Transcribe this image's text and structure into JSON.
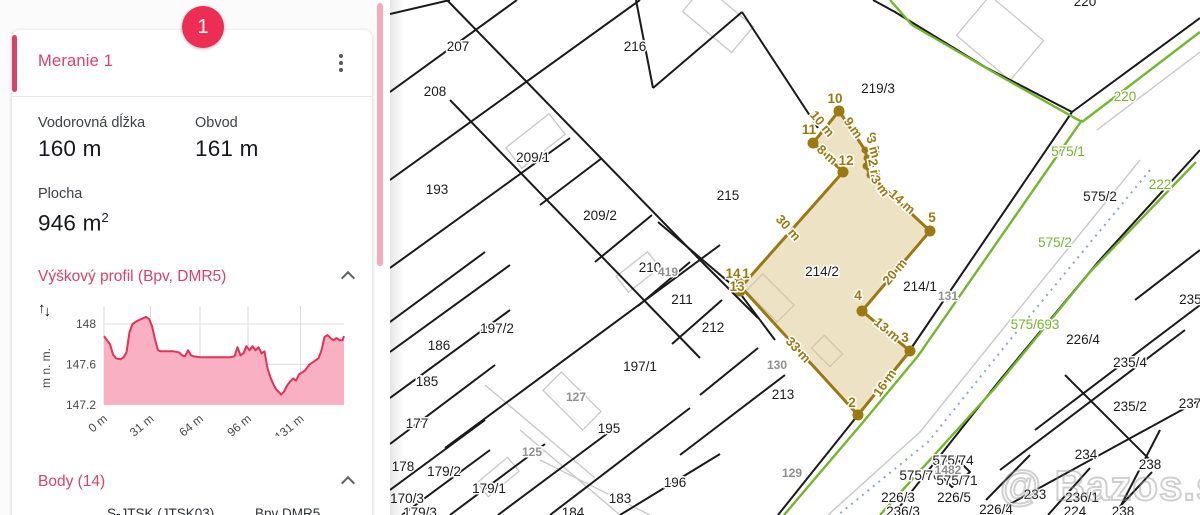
{
  "colors": {
    "accent_pink": "#d94368",
    "badge_red": "#ee2d55",
    "scrollbar_pink": "#f6a8bc",
    "value_dark": "#16181d",
    "chart_line": "#e73058",
    "chart_fill": "#f8b0c2",
    "map_line": "#1a1a1a",
    "map_green": "#74b62c",
    "map_gray": "#c9c9c9",
    "map_dotted": "#8fa6c2",
    "gold": "#9a7a10",
    "gold_fill": "rgba(222,197,138,0.5)",
    "parcel_label": "#1c1c1c",
    "gray_label": "#8f8f8f"
  },
  "panel": {
    "badge": "1",
    "title": "Meranie 1",
    "metric1_label": "Vodorovná dĺžka",
    "metric1_value": "160 m",
    "metric2_label": "Obvod",
    "metric2_value": "161 m",
    "area_label": "Plocha",
    "area_value": "946 m",
    "area_sup": "2",
    "profile_title": "Výškový profil (Bpv, DMR5)",
    "body_title": "Body (14)",
    "body_table_col1": "S-JTSK (JTSK03)",
    "body_table_col2": "Bpv DMR5"
  },
  "chart_data": {
    "type": "area",
    "title": "Výškový profil (Bpv, DMR5)",
    "ylabel": "m n. m.",
    "xlabel": "",
    "xlim": [
      0,
      160
    ],
    "ylim": [
      147.2,
      148.1
    ],
    "y_ticks": [
      "148",
      "147.6",
      "147.2"
    ],
    "y_tick_values": [
      148,
      147.6,
      147.2
    ],
    "x_ticks": [
      "0 m",
      "31 m",
      "64 m",
      "96 m",
      "131 m"
    ],
    "x_tick_values": [
      0,
      31,
      64,
      96,
      131
    ],
    "grid": true,
    "profile": [
      [
        0,
        147.88
      ],
      [
        2,
        147.84
      ],
      [
        4,
        147.8
      ],
      [
        6,
        147.7
      ],
      [
        8,
        147.66
      ],
      [
        11,
        147.65
      ],
      [
        13,
        147.67
      ],
      [
        15,
        147.72
      ],
      [
        17,
        147.92
      ],
      [
        19,
        148.0
      ],
      [
        22,
        148.03
      ],
      [
        25,
        148.05
      ],
      [
        28,
        148.07
      ],
      [
        30,
        148.05
      ],
      [
        32,
        147.98
      ],
      [
        34,
        147.85
      ],
      [
        36,
        147.74
      ],
      [
        38,
        147.73
      ],
      [
        42,
        147.73
      ],
      [
        46,
        147.73
      ],
      [
        50,
        147.72
      ],
      [
        52,
        147.69
      ],
      [
        54,
        147.68
      ],
      [
        56,
        147.74
      ],
      [
        58,
        147.69
      ],
      [
        60,
        147.68
      ],
      [
        64,
        147.67
      ],
      [
        68,
        147.67
      ],
      [
        72,
        147.67
      ],
      [
        76,
        147.67
      ],
      [
        80,
        147.67
      ],
      [
        84,
        147.67
      ],
      [
        87,
        147.68
      ],
      [
        89,
        147.77
      ],
      [
        91,
        147.69
      ],
      [
        93,
        147.71
      ],
      [
        95,
        147.78
      ],
      [
        97,
        147.74
      ],
      [
        99,
        147.78
      ],
      [
        101,
        147.74
      ],
      [
        103,
        147.77
      ],
      [
        105,
        147.71
      ],
      [
        107,
        147.73
      ],
      [
        109,
        147.56
      ],
      [
        111,
        147.47
      ],
      [
        113,
        147.4
      ],
      [
        115,
        147.35
      ],
      [
        117,
        147.32
      ],
      [
        118,
        147.3
      ],
      [
        120,
        147.33
      ],
      [
        122,
        147.39
      ],
      [
        124,
        147.43
      ],
      [
        126,
        147.46
      ],
      [
        128,
        147.44
      ],
      [
        130,
        147.5
      ],
      [
        132,
        147.52
      ],
      [
        134,
        147.54
      ],
      [
        137,
        147.6
      ],
      [
        140,
        147.63
      ],
      [
        143,
        147.66
      ],
      [
        145,
        147.74
      ],
      [
        147,
        147.87
      ],
      [
        149,
        147.89
      ],
      [
        151,
        147.86
      ],
      [
        153,
        147.84
      ],
      [
        155,
        147.86
      ],
      [
        157,
        147.84
      ],
      [
        159,
        147.84
      ],
      [
        160,
        147.88
      ]
    ]
  },
  "map": {
    "watermark": "@ Bazos.sk",
    "parcel_labels": [
      {
        "t": "207",
        "x": 68,
        "y": 47
      },
      {
        "t": "208",
        "x": 45,
        "y": 92
      },
      {
        "t": "216",
        "x": 245,
        "y": 47
      },
      {
        "t": "219/3",
        "x": 488,
        "y": 89
      },
      {
        "t": "193",
        "x": 47,
        "y": 190
      },
      {
        "t": "209/1",
        "x": 143,
        "y": 158
      },
      {
        "t": "215",
        "x": 338,
        "y": 196
      },
      {
        "t": "209/2",
        "x": 210,
        "y": 216
      },
      {
        "t": "210",
        "x": 260,
        "y": 268
      },
      {
        "t": "211",
        "x": 292,
        "y": 300
      },
      {
        "t": "212",
        "x": 323,
        "y": 328
      },
      {
        "t": "214/2",
        "x": 432,
        "y": 272
      },
      {
        "t": "214/1",
        "x": 530,
        "y": 287
      },
      {
        "t": "197/2",
        "x": 107,
        "y": 329
      },
      {
        "t": "186",
        "x": 49,
        "y": 346
      },
      {
        "t": "185",
        "x": 37,
        "y": 382
      },
      {
        "t": "177",
        "x": 27,
        "y": 424
      },
      {
        "t": "197/1",
        "x": 250,
        "y": 367
      },
      {
        "t": "195",
        "x": 219,
        "y": 429
      },
      {
        "t": "213",
        "x": 393,
        "y": 395
      },
      {
        "t": "178",
        "x": 13,
        "y": 467
      },
      {
        "t": "179/2",
        "x": 54,
        "y": 472
      },
      {
        "t": "179/1",
        "x": 99,
        "y": 489
      },
      {
        "t": "170/3",
        "x": 17,
        "y": 499
      },
      {
        "t": "179/3",
        "x": 30,
        "y": 513
      },
      {
        "t": "183",
        "x": 230,
        "y": 499
      },
      {
        "t": "184",
        "x": 183,
        "y": 513
      },
      {
        "t": "196",
        "x": 285,
        "y": 483
      },
      {
        "t": "226/4",
        "x": 693,
        "y": 340
      },
      {
        "t": "235/4",
        "x": 740,
        "y": 363
      },
      {
        "t": "235/2",
        "x": 740,
        "y": 407
      },
      {
        "t": "234",
        "x": 696,
        "y": 455
      },
      {
        "t": "238",
        "x": 760,
        "y": 465
      },
      {
        "t": "237",
        "x": 800,
        "y": 404
      },
      {
        "t": "233",
        "x": 645,
        "y": 495
      },
      {
        "t": "236/1",
        "x": 692,
        "y": 498
      },
      {
        "t": "226/4",
        "x": 606,
        "y": 510
      },
      {
        "t": "224",
        "x": 685,
        "y": 512
      },
      {
        "t": "238",
        "x": 733,
        "y": 512
      },
      {
        "t": "226/3",
        "x": 508,
        "y": 498
      },
      {
        "t": "226/5",
        "x": 564,
        "y": 498
      },
      {
        "t": "236/3",
        "x": 513,
        "y": 512
      },
      {
        "t": "575/2",
        "x": 710,
        "y": 197
      },
      {
        "t": "220",
        "x": 695,
        "y": 2
      },
      {
        "t": "575/70",
        "x": 530,
        "y": 476
      },
      {
        "t": "575/71",
        "x": 567,
        "y": 481
      },
      {
        "t": "575/74",
        "x": 563,
        "y": 461
      },
      {
        "t": "235/1",
        "x": 806,
        "y": 300
      }
    ],
    "gray_labels": [
      {
        "t": "419",
        "x": 278,
        "y": 272
      },
      {
        "t": "127",
        "x": 186,
        "y": 397
      },
      {
        "t": "125",
        "x": 142,
        "y": 452
      },
      {
        "t": "129",
        "x": 402,
        "y": 473
      },
      {
        "t": "130",
        "x": 387,
        "y": 365
      },
      {
        "t": "131",
        "x": 558,
        "y": 296
      },
      {
        "t": "1482",
        "x": 558,
        "y": 470
      }
    ],
    "green_labels": [
      {
        "t": "220",
        "x": 735,
        "y": 97
      },
      {
        "t": "575/1",
        "x": 678,
        "y": 152
      },
      {
        "t": "575/2",
        "x": 665,
        "y": 243
      },
      {
        "t": "575/693",
        "x": 645,
        "y": 325
      },
      {
        "t": "222",
        "x": 770,
        "y": 185
      }
    ],
    "black_lines": [
      "0,14 60,0",
      "0,92 127,0",
      "0,180 250,0",
      "0,268 180,138",
      "0,322 95,252",
      "0,352 120,265",
      "0,398 120,310",
      "0,444 105,365",
      "0,490 95,420",
      "12,515 100,450",
      "60,515 155,444",
      "108,515 230,424",
      "55,448 330,245",
      "160,515 300,408",
      "230,515 330,454",
      "290,455 395,375",
      "57,0 312,262",
      "60,100 310,358",
      "150,205 212,158",
      "205,262 262,215",
      "248,306 300,262",
      "282,344 332,300",
      "310,395 368,348",
      "263,88 352,12",
      "263,88 246,0",
      "428,128 352,12",
      "348,290 268,222",
      "352,296 385,340",
      "312,262 368,318",
      "682,112 520,350 468,415 388,515",
      "682,112 595,67 505,12 483,0",
      "682,112 810,18",
      "810,150 708,262 610,380 503,515",
      "645,430 810,305",
      "610,470 795,330",
      "600,515 810,400",
      "770,430 726,515",
      "675,375 760,460",
      "745,300 810,250",
      "640,455 596,500",
      "700,468 658,515",
      "762,472 722,515",
      "545,470 563,455 580,472 562,487 545,470"
    ],
    "green_lines": [
      "692,120 528,356 474,421 394,515",
      "810,32 692,122",
      "692,122 610,76 522,25 500,0",
      "806,162 700,272 605,388 490,515"
    ],
    "gray_lines": [
      "750,160 612,330 530,432 438,515",
      "707,130 810,52",
      "130,430 230,515",
      "95,385 205,478",
      "150,460 260,515"
    ],
    "dotted_lines": [
      "760,170 620,340 538,442 448,515"
    ],
    "buildings": [
      {
        "x": 118,
        "y": 128,
        "w": 55,
        "h": 26,
        "r": -38
      },
      {
        "x": 358,
        "y": 286,
        "w": 44,
        "h": 24,
        "r": 45
      },
      {
        "x": 424,
        "y": 342,
        "w": 26,
        "h": 18,
        "r": 45
      },
      {
        "x": 228,
        "y": 262,
        "w": 40,
        "h": 20,
        "r": -38
      },
      {
        "x": 296,
        "y": 2,
        "w": 64,
        "h": 34,
        "r": 40
      },
      {
        "x": 575,
        "y": 12,
        "w": 70,
        "h": 52,
        "r": 40
      },
      {
        "x": 88,
        "y": 468,
        "w": 40,
        "h": 18,
        "r": -40
      },
      {
        "x": 154,
        "y": 388,
        "w": 56,
        "h": 26,
        "r": 45
      }
    ],
    "measurement": {
      "polygon": "351,287 453,172 423,143 449,111 475,150 477,158 476,166 480,175 540,231 472,311 520,351 468,415",
      "vertices_large": [
        [
          449,
          111
        ],
        [
          423,
          143
        ],
        [
          453,
          172
        ],
        [
          540,
          231
        ],
        [
          472,
          311
        ],
        [
          520,
          351
        ],
        [
          468,
          415
        ],
        [
          349,
          283
        ],
        [
          350,
          291
        ]
      ],
      "vertices_small": [
        [
          475,
          150
        ],
        [
          477,
          158
        ],
        [
          476,
          166
        ],
        [
          480,
          175
        ]
      ],
      "vertex_labels": [
        {
          "t": "10",
          "x": 445,
          "y": 99
        },
        {
          "t": "11",
          "x": 419,
          "y": 130
        },
        {
          "t": "12",
          "x": 456,
          "y": 161
        },
        {
          "t": "9",
          "x": 483,
          "y": 138
        },
        {
          "t": "8",
          "x": 486,
          "y": 151
        },
        {
          "t": "7",
          "x": 484,
          "y": 163
        },
        {
          "t": "6",
          "x": 487,
          "y": 175
        },
        {
          "t": "5",
          "x": 542,
          "y": 218
        },
        {
          "t": "4",
          "x": 468,
          "y": 296
        },
        {
          "t": "3",
          "x": 515,
          "y": 338
        },
        {
          "t": "2",
          "x": 462,
          "y": 403
        },
        {
          "t": "14",
          "x": 343,
          "y": 274
        },
        {
          "t": "1",
          "x": 356,
          "y": 274
        },
        {
          "t": "13",
          "x": 347,
          "y": 287
        }
      ],
      "edge_labels": [
        {
          "t": "8 m",
          "x": 437,
          "y": 155,
          "r": 42
        },
        {
          "t": "9 m",
          "x": 463,
          "y": 128,
          "r": 55
        },
        {
          "t": "3 m",
          "x": 483,
          "y": 147,
          "r": 75
        },
        {
          "t": "2 m",
          "x": 484,
          "y": 170,
          "r": 80
        },
        {
          "t": "3 m",
          "x": 490,
          "y": 186,
          "r": 55
        },
        {
          "t": "14 m",
          "x": 512,
          "y": 202,
          "r": 42
        },
        {
          "t": "20 m",
          "x": 505,
          "y": 272,
          "r": -50
        },
        {
          "t": "13 m",
          "x": 497,
          "y": 330,
          "r": 40
        },
        {
          "t": "16 m",
          "x": 495,
          "y": 383,
          "r": -55
        },
        {
          "t": "33 m",
          "x": 408,
          "y": 350,
          "r": 47
        },
        {
          "t": "30 m",
          "x": 398,
          "y": 228,
          "r": 48
        },
        {
          "t": "10 m",
          "x": 432,
          "y": 124,
          "r": 50
        }
      ]
    }
  }
}
